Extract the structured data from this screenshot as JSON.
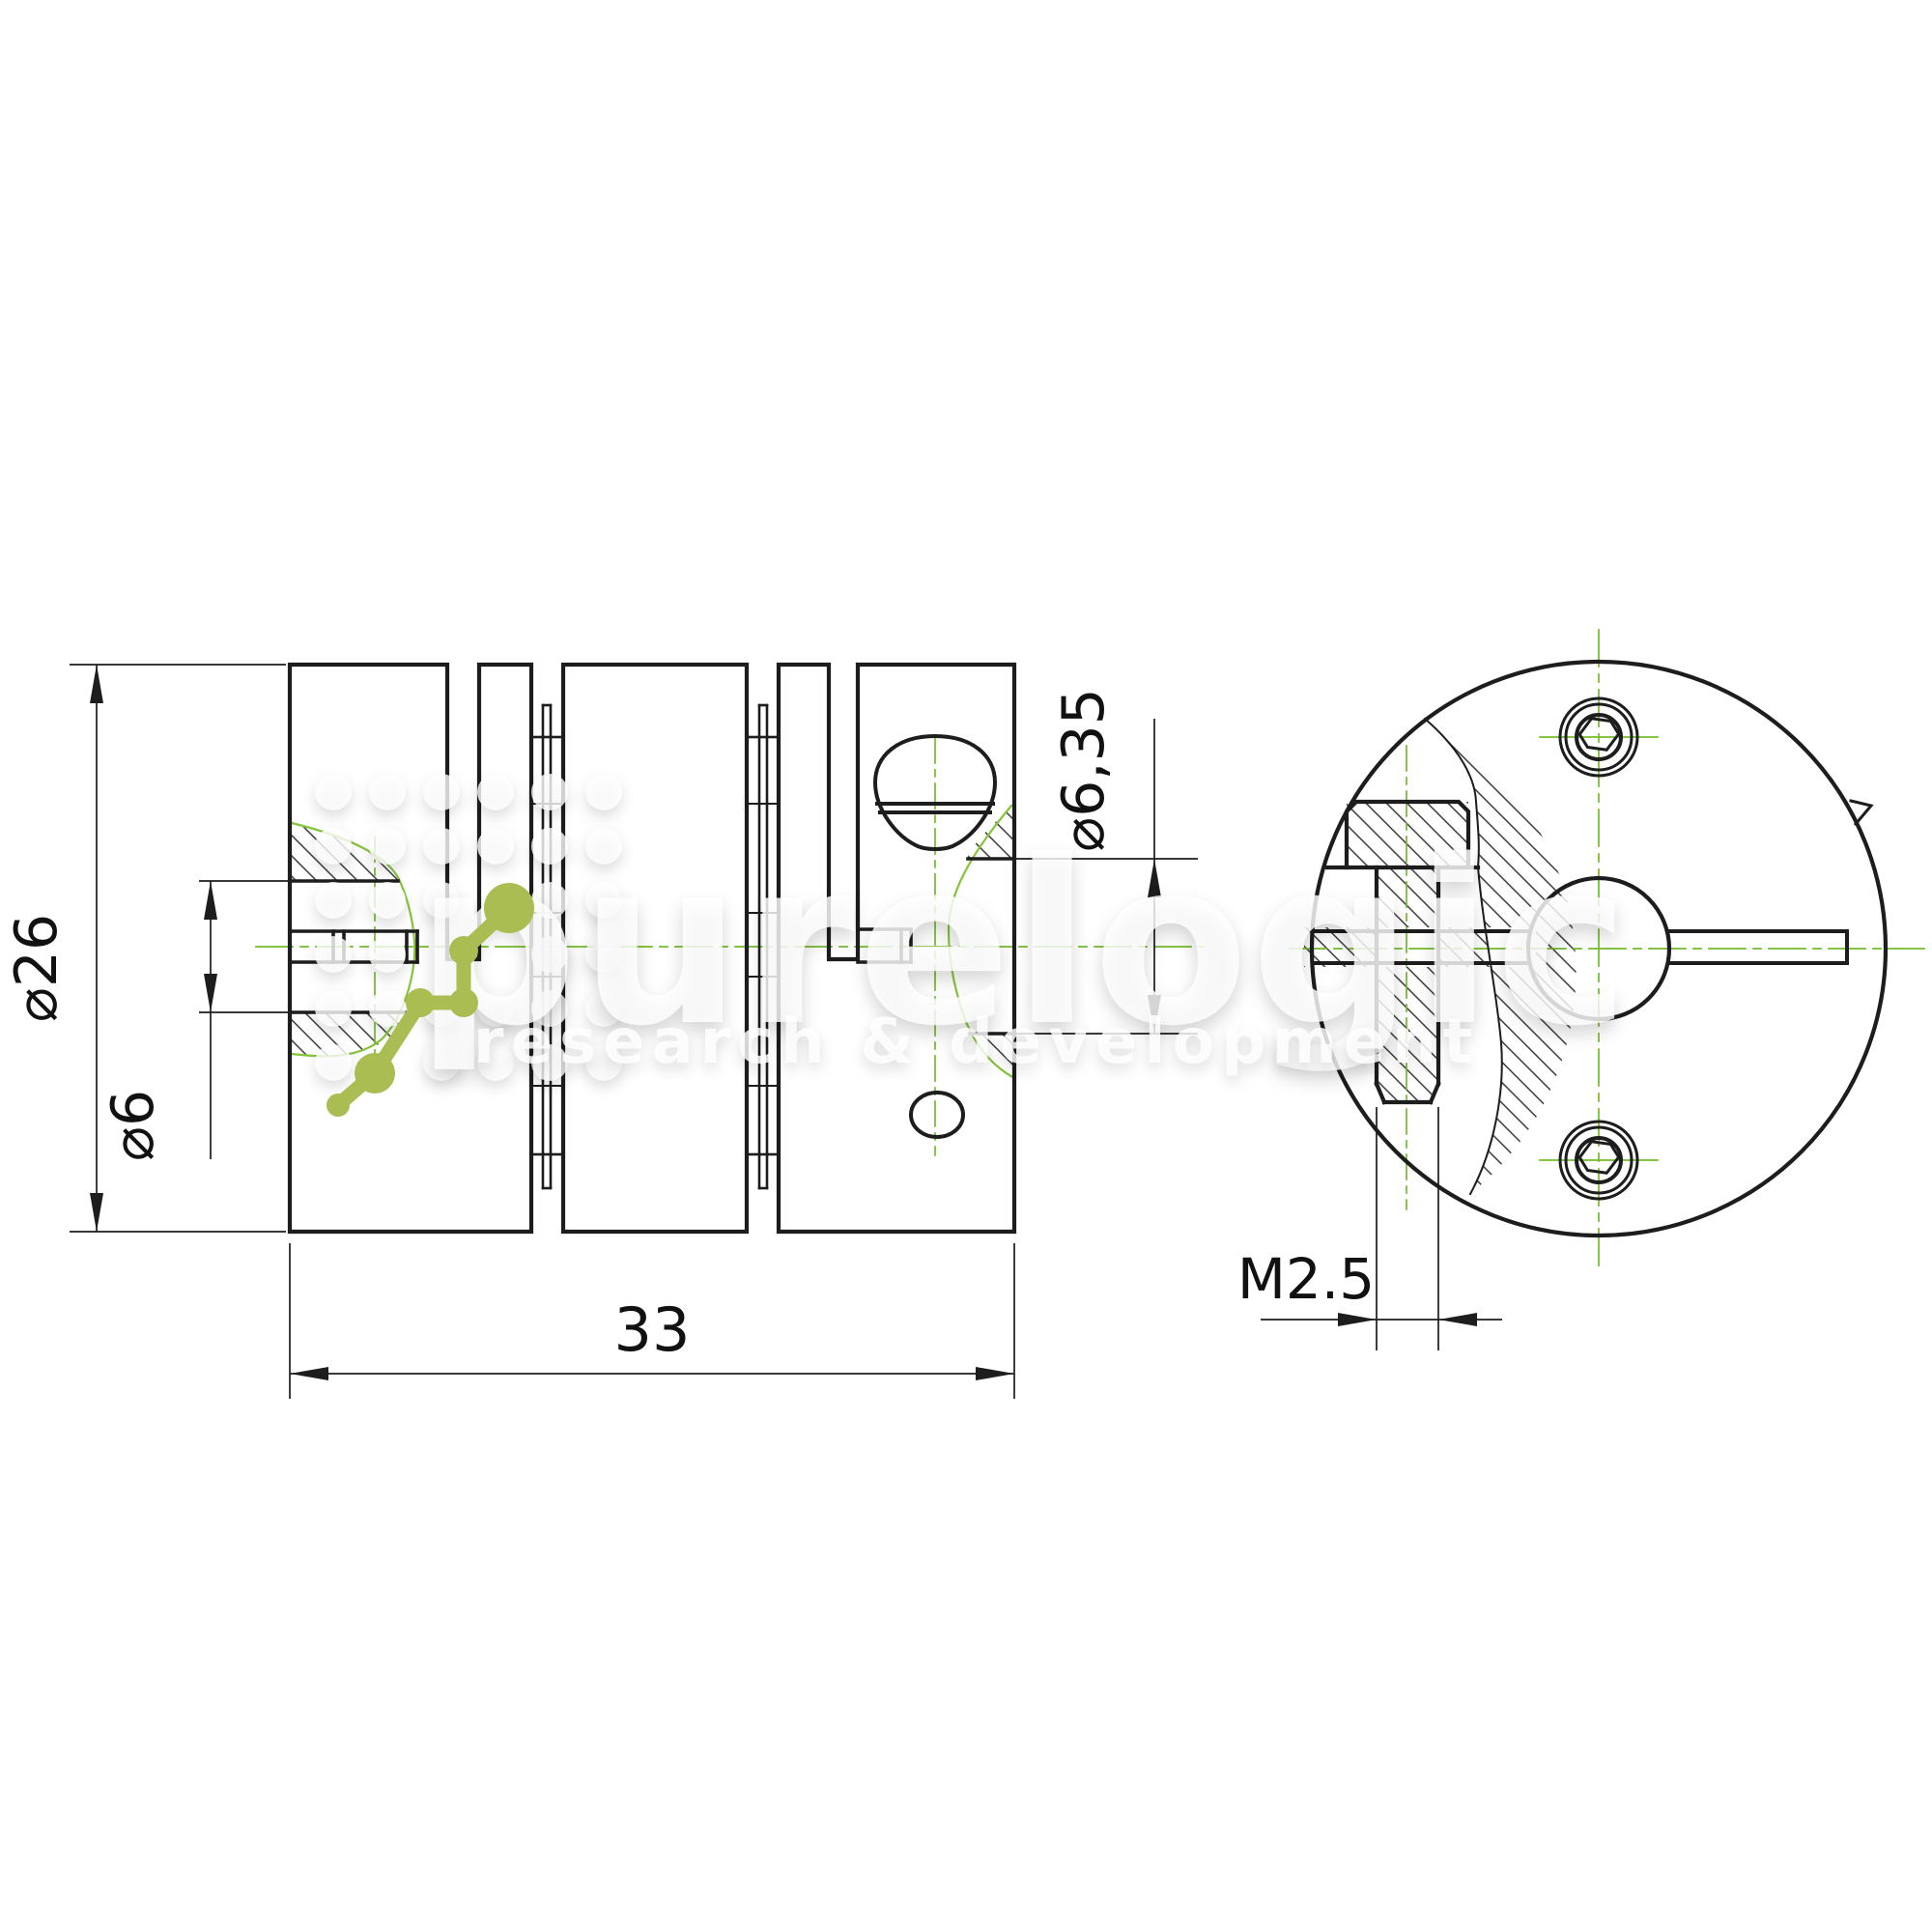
{
  "dimensions": {
    "outer_diameter": "⌀26",
    "left_bore": "⌀6",
    "total_length": "33",
    "right_bore": "⌀6,35",
    "thread_size": "M2.5"
  },
  "watermark": {
    "wordmark": "purelogic",
    "subtitle": "research & development"
  },
  "colors": {
    "line": "#1d1d1d",
    "centerline": "#74bb2b",
    "break_line": "#86c43c",
    "logo_green": "#a9bd52",
    "hatch": "#2b2b2b"
  }
}
